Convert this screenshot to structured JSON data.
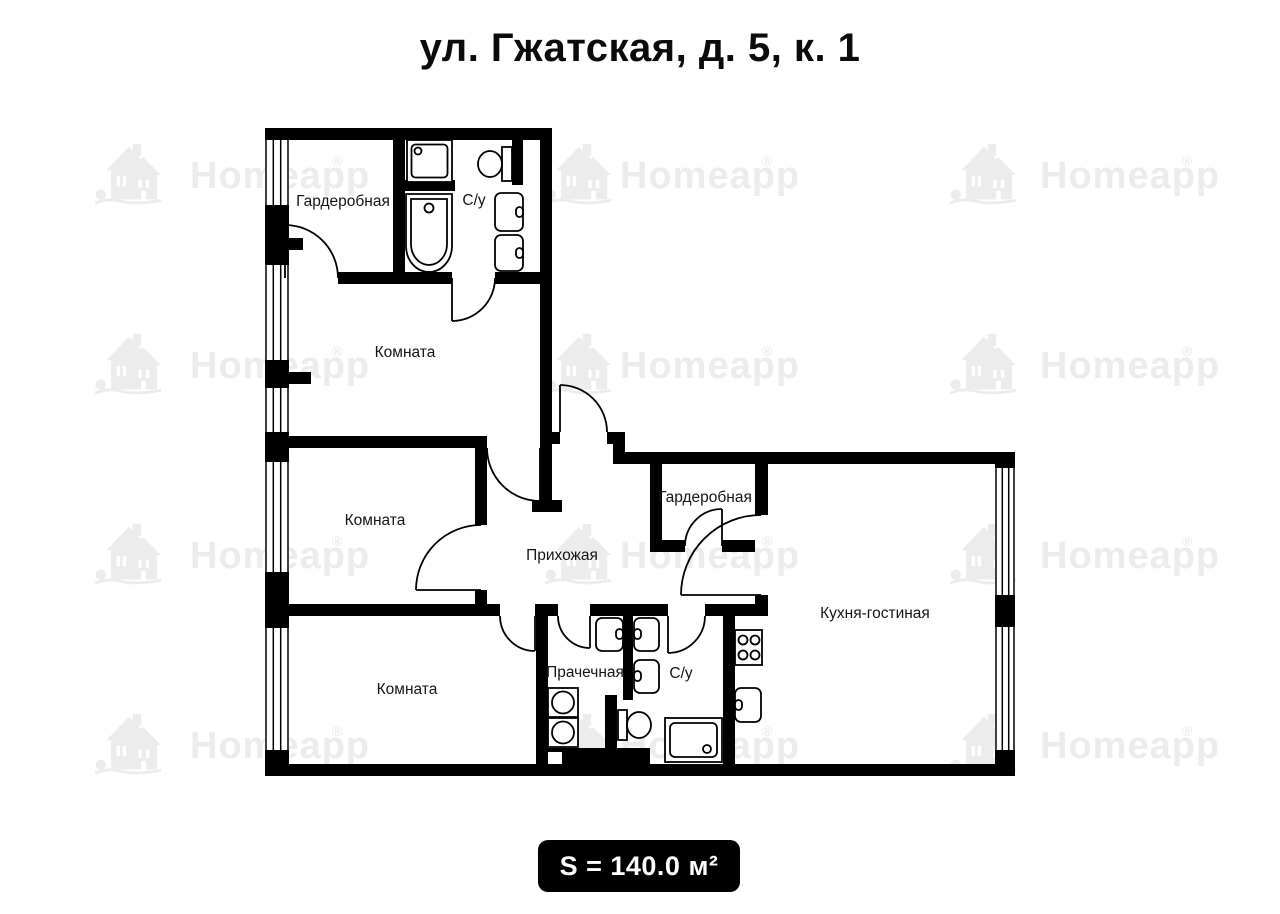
{
  "title": {
    "text": "ул. Гжатская, д. 5, к. 1"
  },
  "watermark": {
    "brand": "Homeapp",
    "registered_mark": "®",
    "color": "#ececec"
  },
  "area_badge": {
    "text": "S = 140.0 м²",
    "background": "#000000",
    "text_color": "#ffffff"
  },
  "floorplan": {
    "wall_color": "#000000",
    "rooms": [
      {
        "id": "wardrobe-top",
        "label": "Гардеробная"
      },
      {
        "id": "bathroom-top",
        "label": "С/у"
      },
      {
        "id": "room-upper",
        "label": "Комната"
      },
      {
        "id": "room-middle",
        "label": "Комната"
      },
      {
        "id": "room-bottom",
        "label": "Комната"
      },
      {
        "id": "hallway",
        "label": "Прихожая"
      },
      {
        "id": "wardrobe-right",
        "label": "Гардеробная"
      },
      {
        "id": "kitchen-living",
        "label": "Кухня-гостиная"
      },
      {
        "id": "laundry",
        "label": "Прачечная"
      },
      {
        "id": "bathroom-bottom",
        "label": "С/у"
      }
    ],
    "fixtures": {
      "bathroom_top": [
        "shower-icon",
        "bathtub-icon",
        "toilet-icon",
        "sink-icon",
        "sink-icon"
      ],
      "laundry": [
        "sink-icon",
        "washing-machine-icon",
        "washing-machine-icon"
      ],
      "bathroom_bottom": [
        "sink-icon",
        "sink-icon",
        "toilet-icon",
        "shower-icon"
      ],
      "kitchen_living": [
        "stove-icon",
        "sink-icon"
      ]
    },
    "windows": {
      "left_wall": 5,
      "right_wall": 2
    }
  }
}
